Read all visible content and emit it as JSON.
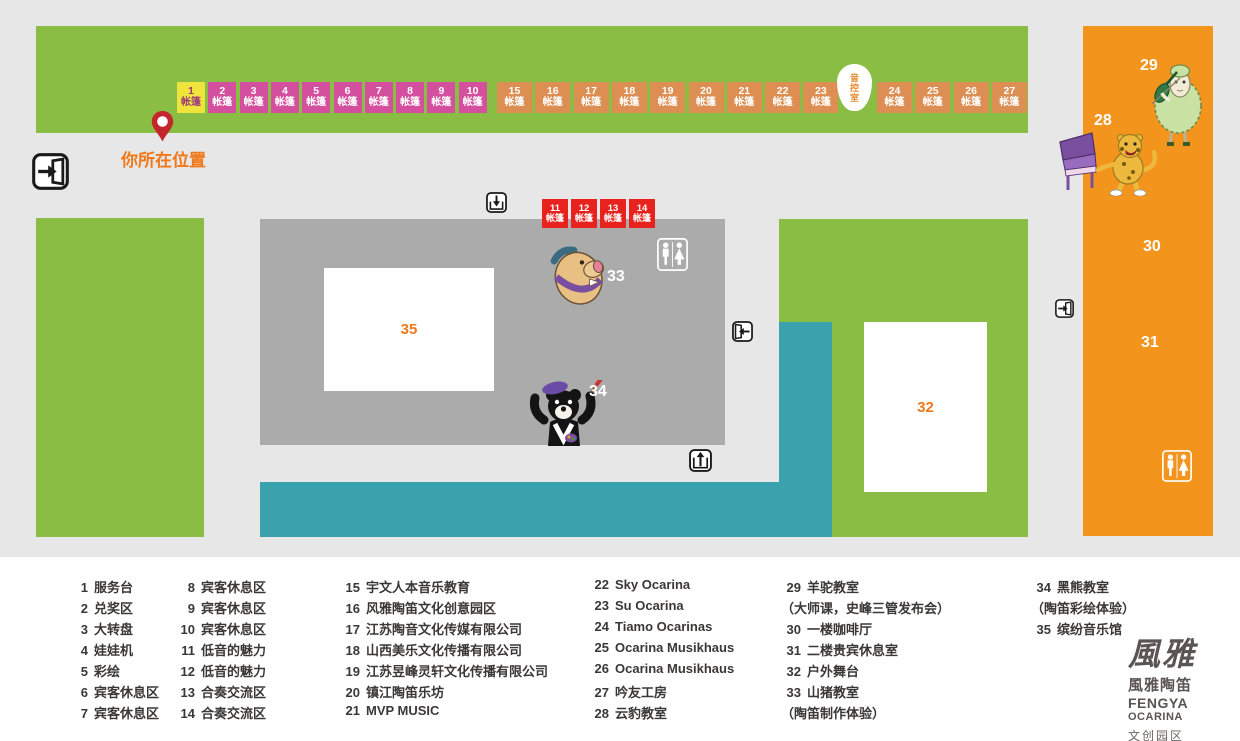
{
  "colors": {
    "map_bg": "#e7e7e7",
    "lawn_green": "#89bd43",
    "building_gray": "#ababab",
    "walkway_teal": "#3aa2ad",
    "building_orange": "#f3941c",
    "tent_yellow": "#f0e33c",
    "tent_magenta": "#d4509e",
    "tent_orange": "#dd8f53",
    "tent_red": "#e8231d",
    "accent_orange": "#f07818",
    "pin_red": "#c4262e",
    "legend_text": "#3a3837"
  },
  "map": {
    "your_location": "你所在位置",
    "tent_word": "帐篷",
    "sound_control_room": "音控室",
    "top_tents": [
      "1",
      "2",
      "3",
      "4",
      "5",
      "6",
      "7",
      "8",
      "9",
      "10",
      "15",
      "16",
      "17",
      "18",
      "19",
      "20",
      "21",
      "22",
      "23",
      "24",
      "25",
      "26",
      "27"
    ],
    "red_tents": [
      "11",
      "12",
      "13",
      "14"
    ],
    "area_labels": {
      "hall35": "35",
      "stage32": "32",
      "cafe30": "30",
      "vip31": "31",
      "leopard_room28": "28",
      "alpaca_room29": "29",
      "boar_room33": "33",
      "bear_room34": "34"
    }
  },
  "legend": {
    "columns": [
      {
        "items": [
          {
            "num": "1",
            "label": "服务台"
          },
          {
            "num": "2",
            "label": "兑奖区"
          },
          {
            "num": "3",
            "label": "大转盘"
          },
          {
            "num": "4",
            "label": "娃娃机"
          },
          {
            "num": "5",
            "label": "彩绘"
          },
          {
            "num": "6",
            "label": "宾客休息区"
          },
          {
            "num": "7",
            "label": "宾客休息区"
          }
        ]
      },
      {
        "items": [
          {
            "num": "8",
            "label": "宾客休息区"
          },
          {
            "num": "9",
            "label": "宾客休息区"
          },
          {
            "num": "10",
            "label": "宾客休息区"
          },
          {
            "num": "11",
            "label": "低音的魅力"
          },
          {
            "num": "12",
            "label": "低音的魅力"
          },
          {
            "num": "13",
            "label": "合奏交流区"
          },
          {
            "num": "14",
            "label": "合奏交流区"
          }
        ]
      },
      {
        "items": [
          {
            "num": "15",
            "label": "宇文人本音乐教育"
          },
          {
            "num": "16",
            "label": "风雅陶笛文化创意园区"
          },
          {
            "num": "17",
            "label": "江苏陶音文化传媒有限公司"
          },
          {
            "num": "18",
            "label": "山西美乐文化传播有限公司"
          },
          {
            "num": "19",
            "label": "江苏昱峰灵轩文化传播有限公司"
          },
          {
            "num": "20",
            "label": "镇江陶笛乐坊"
          },
          {
            "num": "21",
            "label": "MVP MUSIC"
          }
        ]
      },
      {
        "items": [
          {
            "num": "22",
            "label": "Sky Ocarina"
          },
          {
            "num": "23",
            "label": "Su Ocarina"
          },
          {
            "num": "24",
            "label": "Tiamo Ocarinas"
          },
          {
            "num": "25",
            "label": "Ocarina Musikhaus"
          },
          {
            "num": "26",
            "label": "Ocarina Musikhaus"
          },
          {
            "num": "27",
            "label": "吟友工房"
          },
          {
            "num": "28",
            "label": "云豹教室"
          }
        ]
      },
      {
        "items": [
          {
            "num": "29",
            "label": "羊驼教室"
          },
          {
            "num": "",
            "label": "（大师课，史峰三管发布会）"
          },
          {
            "num": "30",
            "label": "一楼咖啡厅"
          },
          {
            "num": "31",
            "label": "二楼贵宾休息室"
          },
          {
            "num": "32",
            "label": "户外舞台"
          },
          {
            "num": "33",
            "label": "山猪教室"
          },
          {
            "num": "",
            "label": "（陶笛制作体验）"
          }
        ]
      },
      {
        "items": [
          {
            "num": "34",
            "label": "黑熊教室"
          },
          {
            "num": "",
            "label": "（陶笛彩绘体验）"
          },
          {
            "num": "35",
            "label": "缤纷音乐馆"
          }
        ]
      }
    ]
  },
  "logo": {
    "calligraphy": "風雅",
    "cn": "風雅陶笛",
    "en1": "FENGYA",
    "en2": "OCARINA",
    "sub": "文创园区"
  }
}
